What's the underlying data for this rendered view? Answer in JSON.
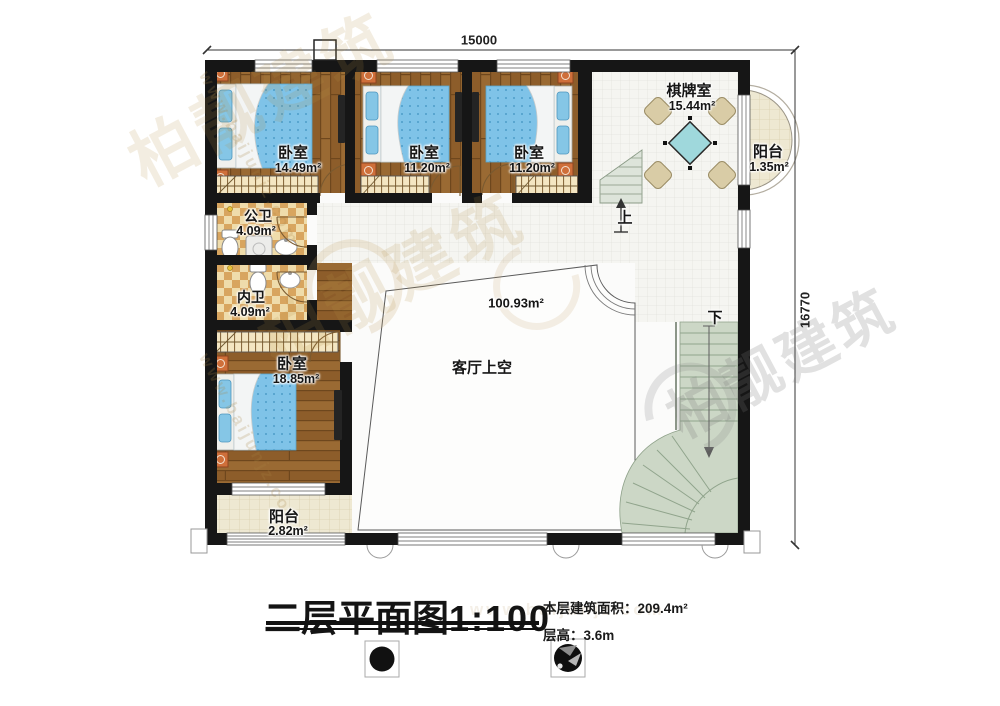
{
  "watermark": {
    "brand": "柏靓建筑",
    "url": "www.baijunjz.com"
  },
  "dimensions": {
    "top": "15000",
    "right": "16770"
  },
  "rooms": {
    "bedroom1": {
      "name": "卧室",
      "area": "14.49m²"
    },
    "bedroom2": {
      "name": "卧室",
      "area": "11.20m²"
    },
    "bedroom3": {
      "name": "卧室",
      "area": "11.20m²"
    },
    "bedroom4": {
      "name": "卧室",
      "area": "18.85m²"
    },
    "chess_room": {
      "name": "棋牌室",
      "area": "15.44m²"
    },
    "balcony_right": {
      "name": "阳台",
      "area": "1.35m²"
    },
    "balcony_bottom": {
      "name": "阳台",
      "area": "2.82m²"
    },
    "public_bath": {
      "name": "公卫",
      "area": "4.09m²"
    },
    "private_bath": {
      "name": "内卫",
      "area": "4.09m²"
    },
    "living_void": {
      "name": "客厅上空",
      "area": "100.93m²"
    }
  },
  "stairs": {
    "up": "上",
    "down": "下"
  },
  "title": {
    "text": "二层平面图",
    "scale": "1:100"
  },
  "stats": {
    "floor_area_label": "本层建筑面积：",
    "floor_area_value": "209.4m²",
    "height_label": "层高：",
    "height_value": "3.6m"
  },
  "colors": {
    "wall": "#161616",
    "wood": "#9a6a33",
    "bed_blue": "#7fc3e8",
    "stair_green": "#ccd7c6",
    "table_teal": "#9fd8dc",
    "bath_tan": "#d8a55f",
    "balcony_cream": "#eee8d2"
  }
}
